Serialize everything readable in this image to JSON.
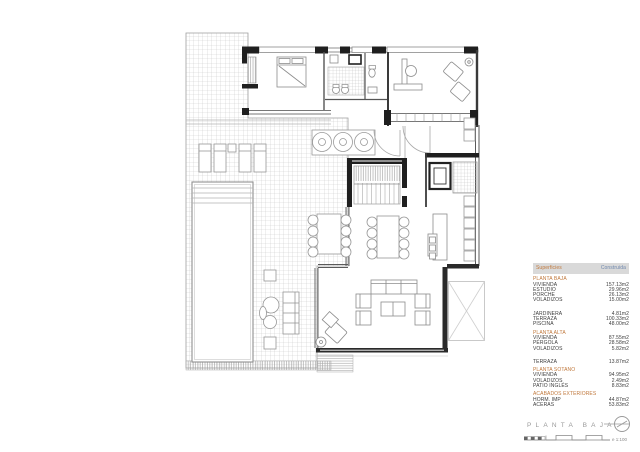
{
  "sheet": {
    "title": "PLANTA BAJA",
    "scale_note": "e 1:100"
  },
  "legend": {
    "header": {
      "col1": "Superficies",
      "col2": "Construida"
    },
    "sections": [
      {
        "title": "PLANTA BAJA",
        "gap": false,
        "rows": [
          [
            "VIVIENDA",
            "157.13m2"
          ],
          [
            "ESTUDIO",
            "29.96m2"
          ],
          [
            "PORCHE",
            "26.13m2"
          ],
          [
            "VOLADIZOS",
            "15.00m2"
          ]
        ]
      },
      {
        "title": "",
        "gap": true,
        "rows": [
          [
            "JARDINERA",
            "4.81m2"
          ],
          [
            "TERRAZA",
            "100.33m2"
          ],
          [
            "PISCINA",
            "48.00m2"
          ]
        ]
      },
      {
        "title": "PLANTA ALTA",
        "gap": false,
        "rows": [
          [
            "VIVIENDA",
            "87.55m2"
          ],
          [
            "PÉRGOLA",
            "28.58m2"
          ],
          [
            "VOLADIZOS",
            "5.82m2"
          ]
        ]
      },
      {
        "title": "",
        "gap": true,
        "rows": [
          [
            "TERRAZA",
            "13.87m2"
          ]
        ]
      },
      {
        "title": "PLANTA SOTANO",
        "gap": false,
        "rows": [
          [
            "VIVIENDA",
            "94.95m2"
          ],
          [
            "VOLADIZOS",
            "2.49m2"
          ],
          [
            "PATIO INGLÉS",
            "8.83m2"
          ]
        ]
      },
      {
        "title": "ACABADOS EXTERIORES",
        "gap": false,
        "rows": [
          [
            "HORM. IMP",
            "44.87m2"
          ],
          [
            "ACERAS",
            "53.83m2"
          ]
        ]
      }
    ]
  },
  "colors": {
    "accent_orange": "#c0783c",
    "accent_blue": "#6e87ad",
    "header_bg": "#d9d9d9",
    "wall_dark": "#1f1f1f",
    "line_gray": "#8c8c8c"
  },
  "icons": {
    "north_indicator": "circle-with-line"
  }
}
